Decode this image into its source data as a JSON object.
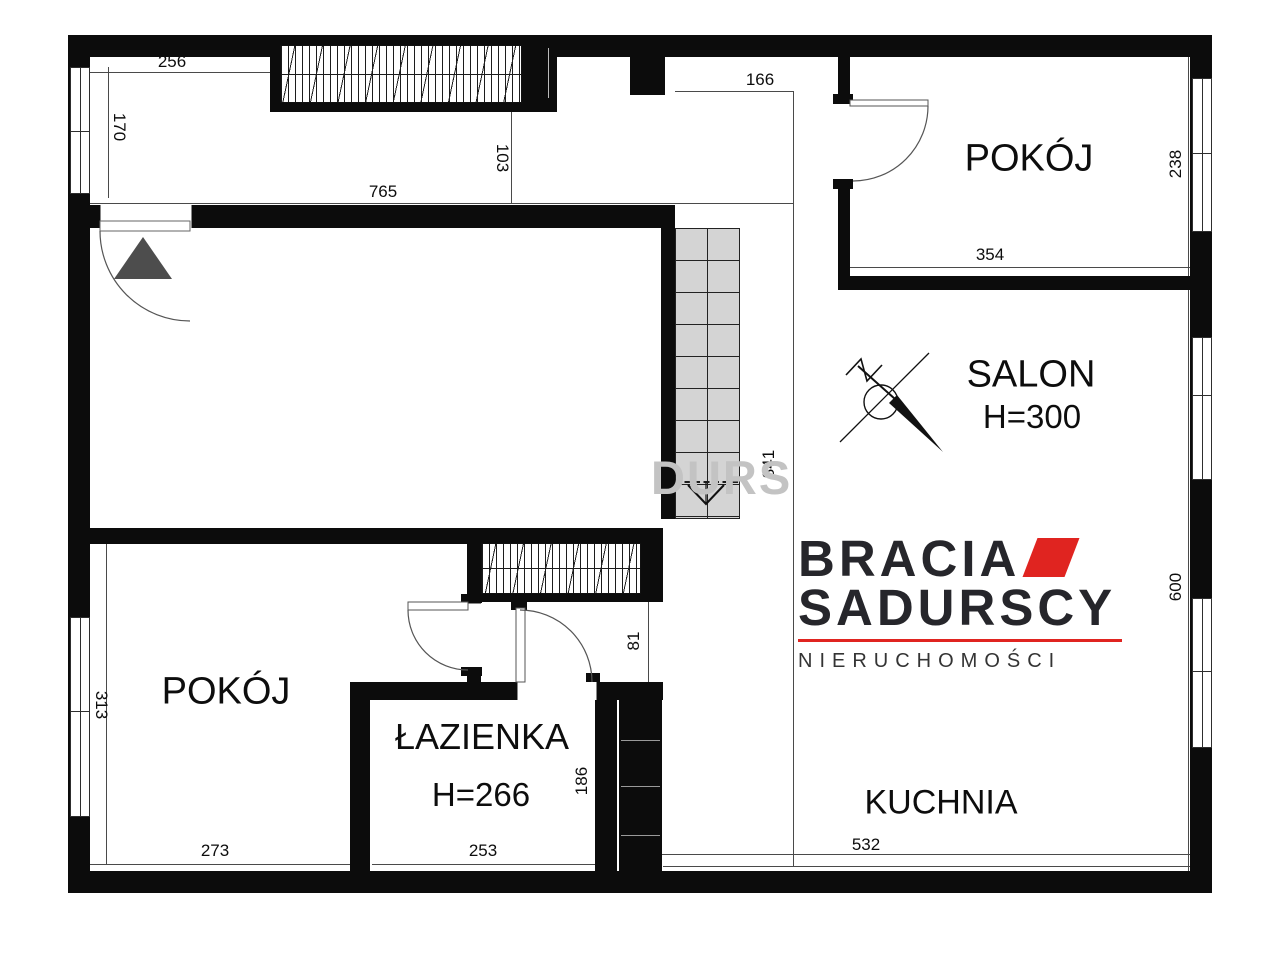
{
  "brand": {
    "line1": "BRACIA",
    "line2": "SADURSCY",
    "tagline": "NIERUCHOMOŚCI",
    "accent_color": "#e02420",
    "text_color": "#26262b"
  },
  "watermark": {
    "text": "DURS"
  },
  "rooms": {
    "pokoj_top_right": {
      "name": "POKÓJ"
    },
    "salon": {
      "name": "SALON",
      "height": "H=300"
    },
    "pokoj_bottom_left": {
      "name": "POKÓJ"
    },
    "lazienka": {
      "name": "ŁAZIENKA",
      "height": "H=266"
    },
    "kuchnia": {
      "name": "KUCHNIA"
    }
  },
  "dimensions": {
    "d256": "256",
    "d170": "170",
    "d765": "765",
    "d103": "103",
    "d166": "166",
    "d238": "238",
    "d354": "354",
    "d841": "841",
    "d600": "600",
    "d313": "313",
    "d273": "273",
    "d253": "253",
    "d186": "186",
    "d81": "81",
    "d532": "532"
  }
}
